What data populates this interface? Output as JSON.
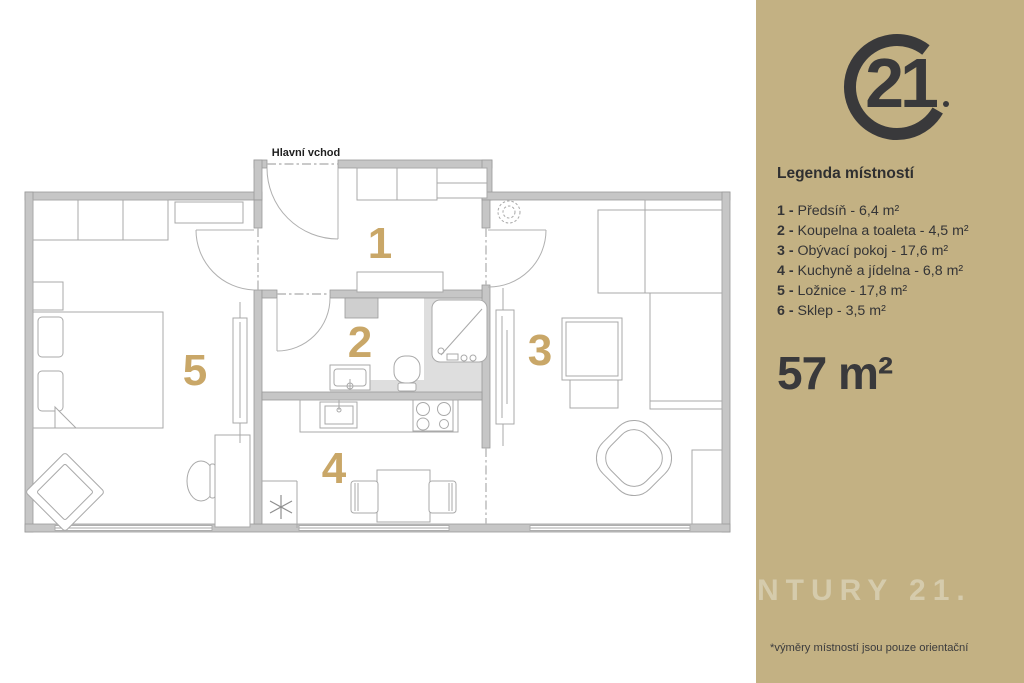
{
  "plan": {
    "entrance_label": "Hlavní vchod",
    "rooms": [
      "1",
      "2",
      "3",
      "4",
      "5"
    ],
    "number_color": "#c9a768",
    "wall_color": "#c6c6c6"
  },
  "sidebar": {
    "bg_color": "#c3b183",
    "accent_dark": "#39393b",
    "logo_text": "21",
    "legend_title": "Legenda místností",
    "legend_items": [
      {
        "bold": "1 -",
        "rest": " Předsíň - 6,4 m²"
      },
      {
        "bold": "2 -",
        "rest": " Koupelna a toaleta - 4,5 m²"
      },
      {
        "bold": "3 -",
        "rest": " Obývací pokoj - 17,6 m²"
      },
      {
        "bold": "4 -",
        "rest": " Kuchyně a jídelna - 6,8 m²"
      },
      {
        "bold": "5 -",
        "rest": " Ložnice - 17,8 m²"
      },
      {
        "bold": "6 -",
        "rest": " Sklep - 3,5 m²"
      }
    ],
    "total_area": "57 m²",
    "watermark": "ENTURY 21.",
    "footnote": "*výměry místností jsou pouze orientační"
  }
}
